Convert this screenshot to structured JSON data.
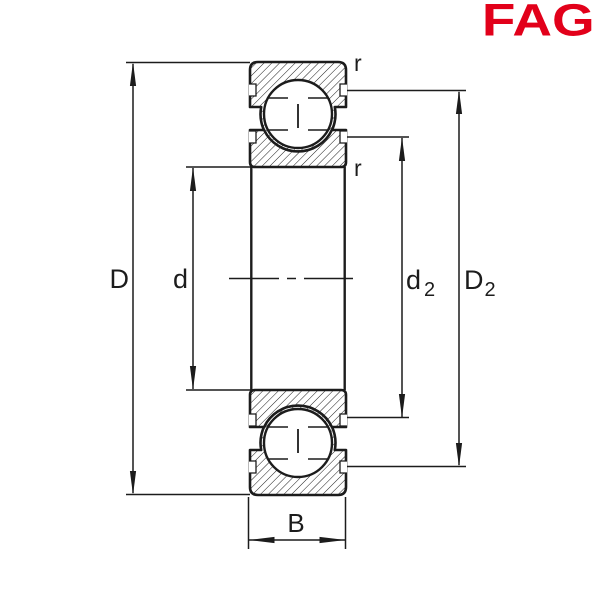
{
  "brand": {
    "name": "FAG",
    "color": "#e2001a"
  },
  "diagram": {
    "ink_color": "#1c1c1c",
    "background": "#ffffff",
    "dimension_labels": {
      "outer_diameter": "D",
      "bore_diameter": "d",
      "inner_shoulder_base": "d",
      "inner_shoulder_sub": "2",
      "outer_shoulder_base": "D",
      "outer_shoulder_sub": "2",
      "width": "B",
      "corner_radius_outer": "r",
      "corner_radius_inner": "r"
    }
  }
}
